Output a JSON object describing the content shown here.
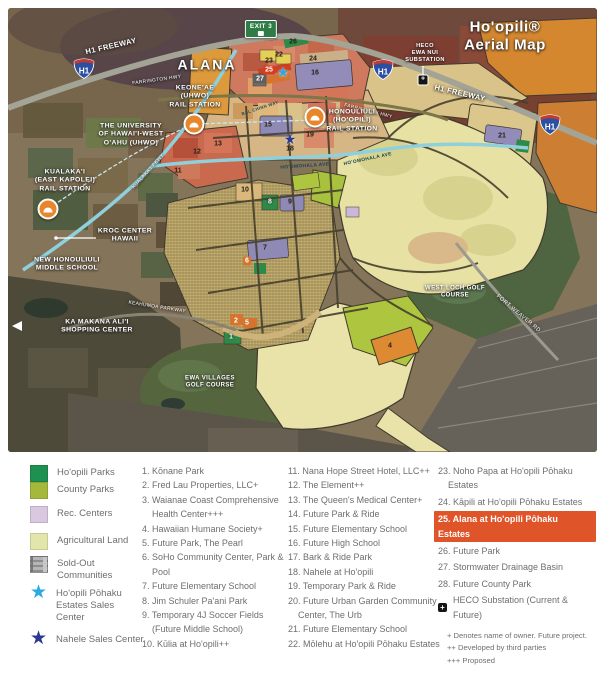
{
  "title": "Ho'opili® Aerial Map",
  "map": {
    "shield_label": "H1",
    "exit_sign": {
      "text": "EXIT 3",
      "x": 253,
      "y": 21
    },
    "labels": [
      {
        "name": "map-title",
        "text": "Ho'opili® Aerial Map",
        "x": 497,
        "y": 29,
        "size": 15,
        "bold": true,
        "spacing": 0.6
      },
      {
        "name": "alana-area-label",
        "text": "ALANA",
        "x": 199,
        "y": 57,
        "size": 14,
        "bold": true,
        "spacing": 2
      },
      {
        "name": "h1-freeway-west-label",
        "text": "H1 FREEWAY",
        "x": 103,
        "y": 38,
        "size": 7.5,
        "bold": true,
        "rot": -13
      },
      {
        "name": "h1-freeway-east-label",
        "text": "H1 FREEWAY",
        "x": 452,
        "y": 85,
        "size": 7.5,
        "bold": true,
        "rot": 13
      },
      {
        "name": "farrington-hwy-west-label",
        "text": "FARRINGTON HWY",
        "x": 149,
        "y": 73,
        "size": 4.8,
        "rot": -8
      },
      {
        "name": "farrington-hwy-east-label",
        "text": "FARRINGTON HWY",
        "x": 360,
        "y": 104,
        "size": 4.8,
        "rot": 14
      },
      {
        "name": "keoneae-rail-station-label",
        "text": "KEONE'AE\n(UHWO)\nRAIL STATION",
        "x": 187,
        "y": 89,
        "size": 6.8,
        "bold": true
      },
      {
        "name": "uhwo-university-label",
        "text": "THE UNIVERSITY\nOF HAWAI'I-WEST\nO'AHU (UHWO)",
        "x": 123,
        "y": 127,
        "size": 6.8,
        "bold": true
      },
      {
        "name": "heco-ewa-nui-substation-label",
        "text": "HECO\nEWA NUI\nSUBSTATION",
        "x": 417,
        "y": 45,
        "size": 5.6,
        "bold": true
      },
      {
        "name": "honouliuli-rail-station-label",
        "text": "HONOULIULI\n(HO'OPILI)\nRAIL STATION",
        "x": 344,
        "y": 113,
        "size": 6.8,
        "bold": true
      },
      {
        "name": "kualakai-rail-station-label",
        "text": "KUALAKA'I\n(EAST KAPOLEI)\nRAIL STATION",
        "x": 57,
        "y": 173,
        "size": 6.8,
        "bold": true
      },
      {
        "name": "kualakai-pkwy-label",
        "text": "KUALAKA'I PKWY",
        "x": 141,
        "y": 164,
        "size": 4.8,
        "rot": -48
      },
      {
        "name": "kroc-center-label",
        "text": "KROC CENTER\nHAWAII",
        "x": 117,
        "y": 228,
        "size": 6.8,
        "bold": true
      },
      {
        "name": "new-honouliuli-middle-school-label",
        "text": "NEW HONOULIULI\nMIDDLE SCHOOL",
        "x": 59,
        "y": 257,
        "size": 6.8,
        "bold": true
      },
      {
        "name": "ka-makana-alii-label",
        "text": "KA MAKANA ALI'I\nSHOPPING CENTER",
        "x": 89,
        "y": 319,
        "size": 6.8,
        "bold": true
      },
      {
        "name": "keahumoa-parkway-label",
        "text": "KEAHUMOA PARKWAY",
        "x": 149,
        "y": 300,
        "size": 4.8,
        "rot": 9
      },
      {
        "name": "ewa-villages-golf-label",
        "text": "EWA VILLAGES\nGOLF COURSE",
        "x": 202,
        "y": 375,
        "size": 6,
        "bold": true
      },
      {
        "name": "west-loch-golf-label",
        "text": "WEST LOCH GOLF\nCOURSE",
        "x": 447,
        "y": 285,
        "size": 6,
        "bold": true
      },
      {
        "name": "fort-weaver-rd-label",
        "text": "FORT WEAVER RD",
        "x": 510,
        "y": 306,
        "size": 5.6,
        "rot": 40
      },
      {
        "name": "hoomohala-ave-label",
        "text": "HO'OMOHALA AVE",
        "x": 297,
        "y": 159,
        "size": 4.8,
        "rot": -4,
        "dark": true
      },
      {
        "name": "hoomohala-ave-label-2",
        "text": "HO'OMOHALA AVE",
        "x": 360,
        "y": 152,
        "size": 4.8,
        "rot": -12,
        "dark": true
      },
      {
        "name": "bal-chinn-way-label",
        "text": "BAL CHINN WAY",
        "x": 252,
        "y": 100,
        "size": 4.2,
        "rot": -18,
        "dark": true
      }
    ],
    "numbers": [
      {
        "n": "26",
        "x": 285,
        "y": 34,
        "kind": "plain"
      },
      {
        "n": "22",
        "x": 271,
        "y": 47,
        "kind": "plain"
      },
      {
        "n": "23",
        "x": 261,
        "y": 53,
        "kind": "plain"
      },
      {
        "n": "25",
        "x": 261,
        "y": 62,
        "kind": "red"
      },
      {
        "n": "27",
        "x": 252,
        "y": 71,
        "kind": "gray"
      },
      {
        "n": "24",
        "x": 305,
        "y": 51,
        "kind": "plain"
      },
      {
        "n": "16",
        "x": 307,
        "y": 65,
        "kind": "plain"
      },
      {
        "n": "21",
        "x": 494,
        "y": 128,
        "kind": "plain"
      },
      {
        "n": "15",
        "x": 260,
        "y": 117,
        "kind": "plain"
      },
      {
        "n": "19",
        "x": 302,
        "y": 127,
        "kind": "plain"
      },
      {
        "n": "18",
        "x": 282,
        "y": 141,
        "kind": "plain"
      },
      {
        "n": "13",
        "x": 210,
        "y": 136,
        "kind": "plain"
      },
      {
        "n": "12",
        "x": 189,
        "y": 144,
        "kind": "plain"
      },
      {
        "n": "11",
        "x": 170,
        "y": 163,
        "kind": "plain"
      },
      {
        "n": "10",
        "x": 237,
        "y": 182,
        "kind": "plain"
      },
      {
        "n": "9",
        "x": 282,
        "y": 194,
        "kind": "plain"
      },
      {
        "n": "8",
        "x": 262,
        "y": 194,
        "kind": "light"
      },
      {
        "n": "7",
        "x": 257,
        "y": 240,
        "kind": "plain"
      },
      {
        "n": "6",
        "x": 239,
        "y": 253,
        "kind": "orange"
      },
      {
        "n": "2",
        "x": 228,
        "y": 313,
        "kind": "orange"
      },
      {
        "n": "5",
        "x": 239,
        "y": 315,
        "kind": "orange"
      },
      {
        "n": "1",
        "x": 223,
        "y": 329,
        "kind": "light"
      },
      {
        "n": "4",
        "x": 382,
        "y": 338,
        "kind": "plain"
      }
    ],
    "stations": [
      {
        "name": "keoneae-rail-station-marker",
        "x": 186,
        "y": 116
      },
      {
        "name": "honouliuli-rail-station-marker",
        "x": 307,
        "y": 109
      },
      {
        "name": "kualakai-rail-station-marker",
        "x": 40,
        "y": 201
      }
    ],
    "stars": [
      {
        "name": "hoopili-pohaku-sales-center-star",
        "color": "#29abe2",
        "x": 275,
        "y": 64
      },
      {
        "name": "nahele-sales-center-star",
        "color": "#2b3990",
        "x": 282,
        "y": 131
      }
    ],
    "shields": [
      {
        "x": 64,
        "y": 48
      },
      {
        "x": 363,
        "y": 49
      },
      {
        "x": 530,
        "y": 104
      }
    ],
    "heco_marker": {
      "x": 415,
      "y": 72,
      "glyph": "+"
    }
  },
  "legend": {
    "items": [
      {
        "label": "Ho'opili Parks",
        "type": "swatch",
        "color": "#1e9050"
      },
      {
        "label": "County Parks",
        "type": "swatch",
        "color": "#a4b93c"
      },
      {
        "label": "Rec. Centers",
        "type": "swatch",
        "color": "#d9c8e0"
      },
      {
        "label": "Agricultural Land",
        "type": "swatch",
        "color": "#e3e6ab"
      },
      {
        "label": "Sold-Out Communities",
        "type": "plaid",
        "color": "#a5a5a5"
      },
      {
        "label": "Ho'opili Pōhaku Estates Sales Center",
        "type": "star",
        "color": "#29abe2"
      },
      {
        "label": "Nahele Sales Center",
        "type": "star",
        "color": "#2b3990"
      }
    ]
  },
  "listing": {
    "col1": [
      "1. Kōnane Park",
      "2. Fred Lau Properties, LLC+",
      "3. Waianae Coast Comprehensive Health Center+++",
      "4. Hawaiian Humane Society+",
      "5. Future Park, The Pearl",
      "6. SoHo Community Center, Park & Pool",
      "7. Future Elementary School",
      "8. Jim Schuler Pa'ani Park",
      "9. Temporary 4J Soccer Fields (Future Middle School)",
      "10. Kūlia at Ho'opili++"
    ],
    "col2": [
      "11. Nana Hope Street Hotel, LLC++",
      "12. The Element++",
      "13. The Queen's Medical Center+",
      "14. Future Park & Ride",
      "15. Future Elementary School",
      "16. Future High School",
      "17. Bark & Ride Park",
      "18. Nahele at Ho'opili",
      "19. Temporary Park & Ride",
      "20. Future Urban Garden Community Center, The Urb",
      "21. Future Elementary School",
      "22. Mōlehu at Ho'opili Pōhaku Estates"
    ],
    "col3": [
      {
        "text": "23. Noho Papa at Ho'opili Pōhaku Estates",
        "highlight": false
      },
      {
        "text": "24. Kāpili at Ho'opili Pōhaku Estates",
        "highlight": false
      },
      {
        "text": "25. Alana at Ho'opili Pōhaku Estates",
        "highlight": true
      },
      {
        "text": "26. Future Park",
        "highlight": false
      },
      {
        "text": "27. Stormwater Drainage Basin",
        "highlight": false
      },
      {
        "text": "28. Future County Park",
        "highlight": false
      }
    ],
    "heco": {
      "icon_glyph": "+",
      "label": "HECO Substation (Current & Future)"
    },
    "footnotes": [
      "+ Denotes name of owner. Future project.",
      "++ Developed by third parties",
      "+++ Proposed"
    ],
    "highlight_color": "#e0542a"
  }
}
